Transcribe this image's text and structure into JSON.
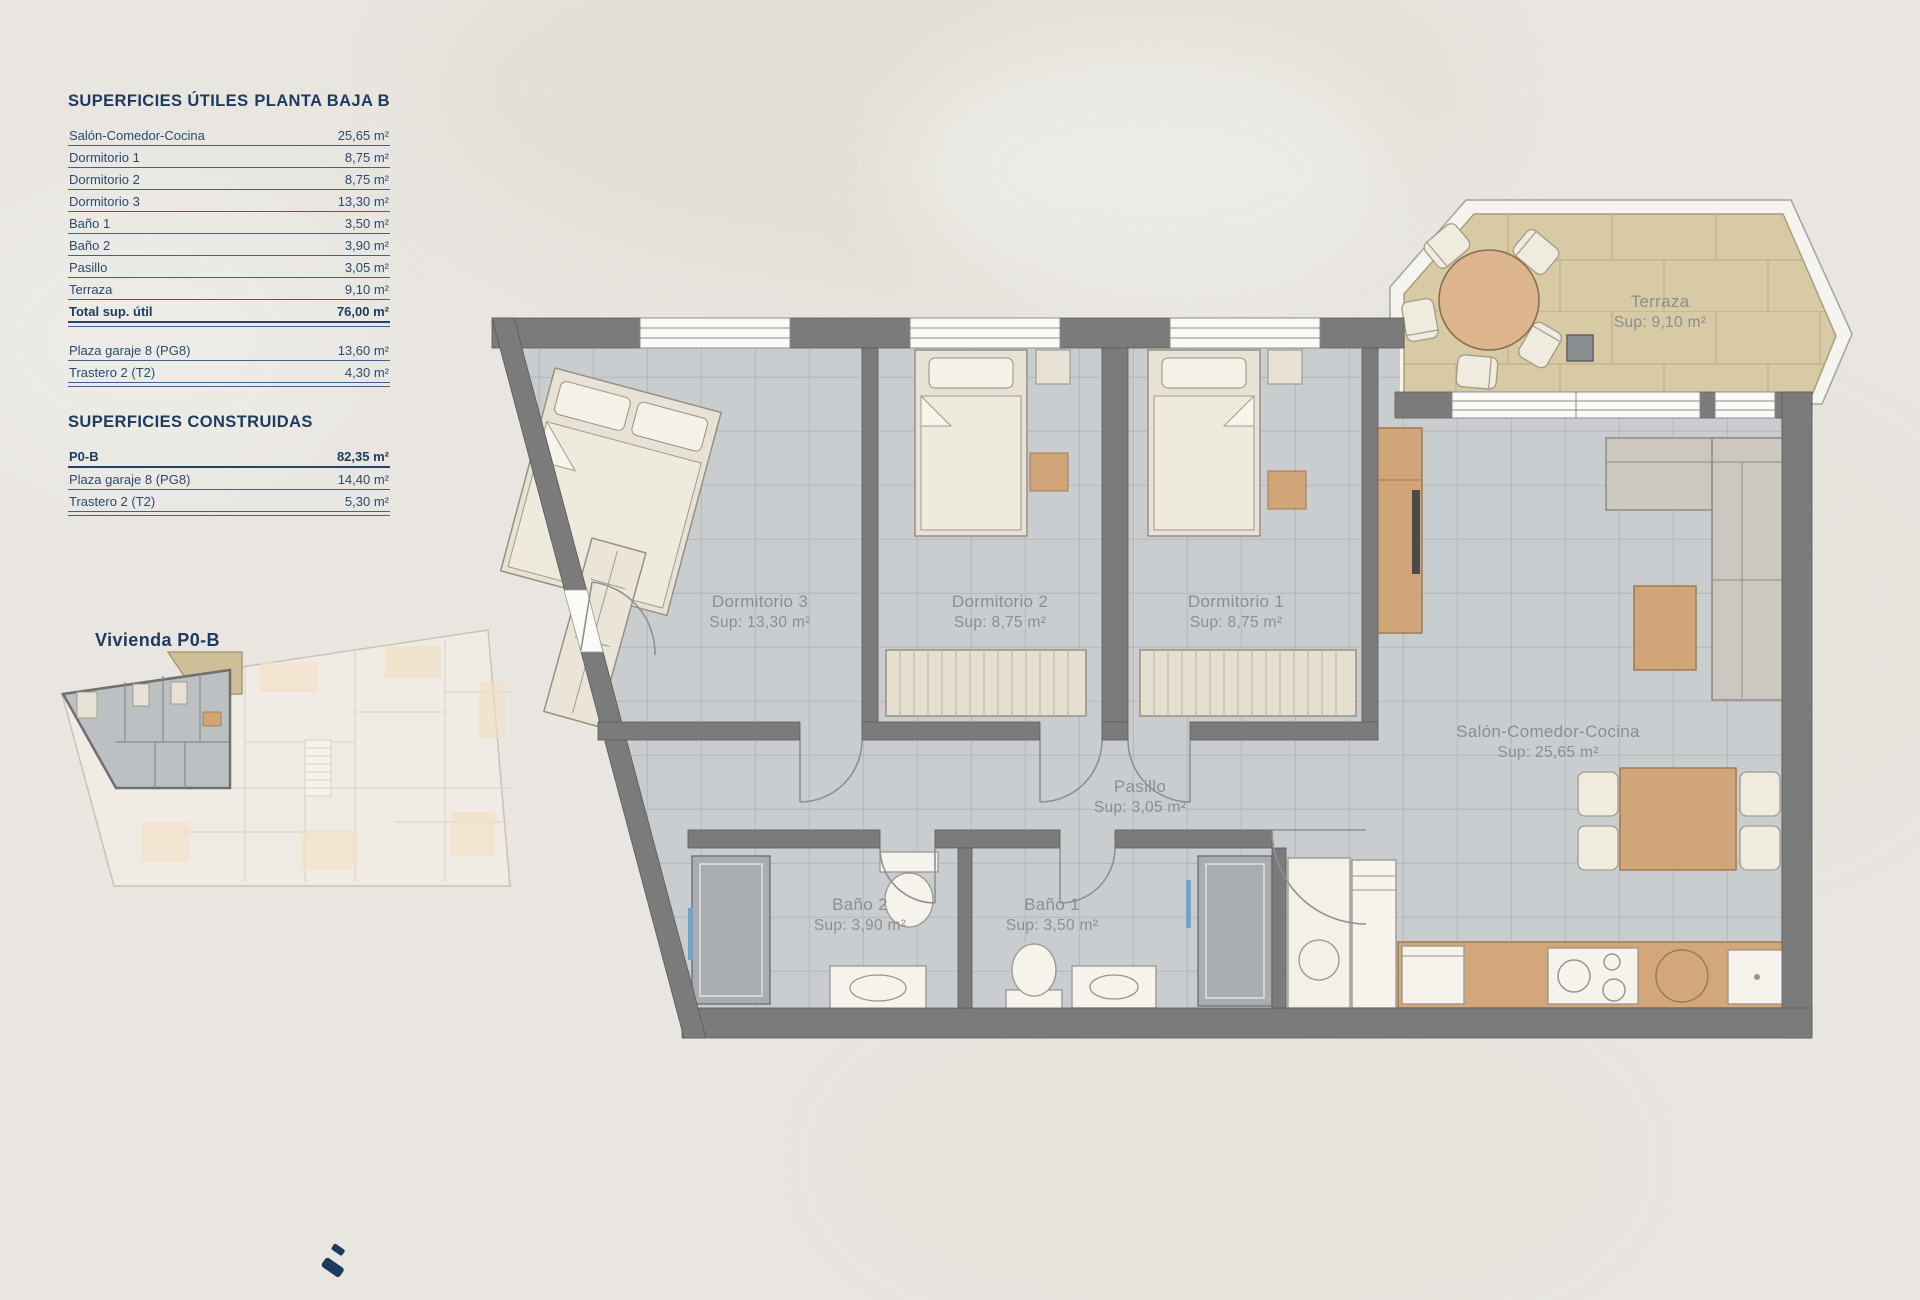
{
  "colors": {
    "accent_navy": "#1d3a5f",
    "wall_gray": "#7b7b7b",
    "floor_tile": "#cacdd0",
    "terrace_tile": "#d7caa5",
    "wood": "#d0a678",
    "label_gray": "#8c8e90"
  },
  "panel": {
    "utiles": {
      "title": "SUPERFICIES ÚTILES",
      "floor": "PLANTA BAJA B",
      "rows": [
        {
          "label": "Salón-Comedor-Cocina",
          "value": "25,65 m²"
        },
        {
          "label": "Dormitorio 1",
          "value": "8,75 m²"
        },
        {
          "label": "Dormitorio 2",
          "value": "8,75 m²"
        },
        {
          "label": "Dormitorio 3",
          "value": "13,30 m²"
        },
        {
          "label": "Baño 1",
          "value": "3,50 m²"
        },
        {
          "label": "Baño 2",
          "value": "3,90 m²"
        },
        {
          "label": "Pasillo",
          "value": "3,05 m²"
        },
        {
          "label": "Terraza",
          "value": "9,10 m²"
        }
      ],
      "total": {
        "label": "Total sup. útil",
        "value": "76,00 m²"
      },
      "annex_rows": [
        {
          "label": "Plaza garaje 8 (PG8)",
          "value": "13,60 m²"
        },
        {
          "label": "Trastero 2 (T2)",
          "value": "4,30 m²"
        }
      ]
    },
    "construidas": {
      "title": "SUPERFICIES CONSTRUIDAS",
      "rows": [
        {
          "label": "P0-B",
          "value": "82,35 m²"
        },
        {
          "label": "Plaza garaje 8 (PG8)",
          "value": "14,40 m²"
        },
        {
          "label": "Trastero 2 (T2)",
          "value": "5,30 m²"
        }
      ]
    }
  },
  "key_plan": {
    "title": "Vivienda P0-B"
  },
  "floor_plan": {
    "rooms": {
      "dormitorio3": {
        "name": "Dormitorio 3",
        "sup": "Sup: 13,30 m²"
      },
      "dormitorio2": {
        "name": "Dormitorio 2",
        "sup": "Sup: 8,75 m²"
      },
      "dormitorio1": {
        "name": "Dormitorio 1",
        "sup": "Sup: 8,75 m²"
      },
      "pasillo": {
        "name": "Pasillo",
        "sup": "Sup: 3,05 m²"
      },
      "bano2": {
        "name": "Baño 2",
        "sup": "Sup: 3,90 m²"
      },
      "bano1": {
        "name": "Baño 1",
        "sup": "Sup: 3,50 m²"
      },
      "salon": {
        "name": "Salón-Comedor-Cocina",
        "sup": "Sup: 25,65 m²"
      },
      "terraza": {
        "name": "Terraza",
        "sup": "Sup: 9,10 m²"
      }
    }
  }
}
